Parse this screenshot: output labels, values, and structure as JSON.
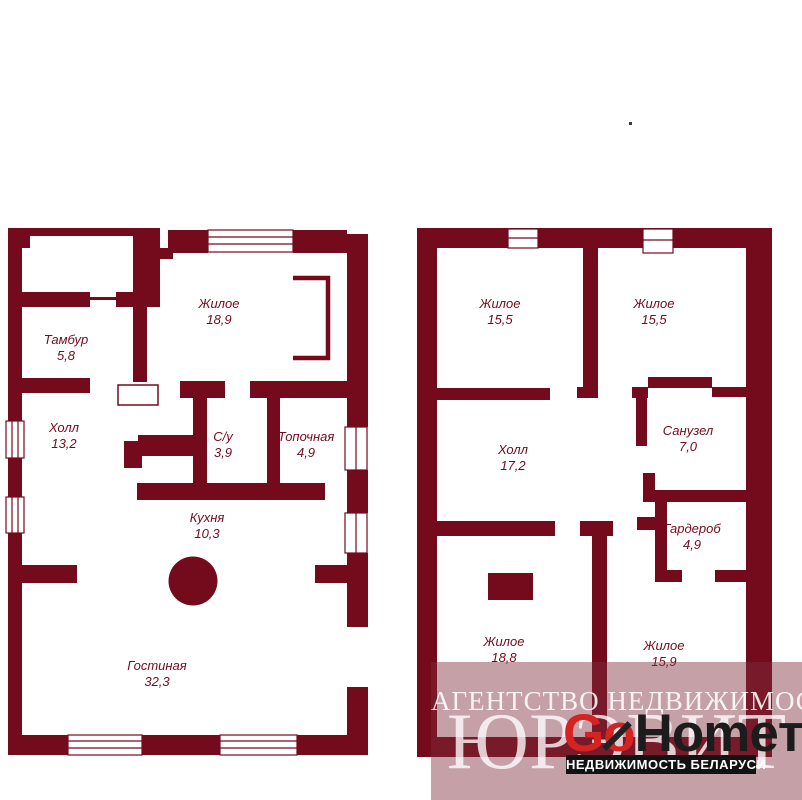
{
  "floor1": {
    "rooms": [
      {
        "name": "Тамбур",
        "area": "5,8"
      },
      {
        "name": "Жилое",
        "area": "18,9"
      },
      {
        "name": "Холл",
        "area": "13,2"
      },
      {
        "name": "С/у",
        "area": "3,9"
      },
      {
        "name": "Топочная",
        "area": "4,9"
      },
      {
        "name": "Кухня",
        "area": "10,3"
      },
      {
        "name": "Гостиная",
        "area": "32,3"
      }
    ]
  },
  "floor2": {
    "rooms": [
      {
        "name": "Жилое",
        "area": "15,5"
      },
      {
        "name": "Жилое",
        "area": "15,5"
      },
      {
        "name": "Холл",
        "area": "17,2"
      },
      {
        "name": "Санузел",
        "area": "7,0"
      },
      {
        "name": "Гардероб",
        "area": "4,9"
      },
      {
        "name": "Жилое",
        "area": "18,8"
      },
      {
        "name": "Жилое",
        "area": "15,9"
      }
    ]
  },
  "watermark": {
    "agency_line": "АГЕНТСТВО НЕДВИЖИМОСТИ",
    "agency_name": "ЮРЭВИТ",
    "logo": {
      "go": "Go",
      "home": "Home",
      "suffix": "т",
      "tagline": "НЕДВИЖИМОСТЬ БЕЛАРУСИ"
    },
    "colors": {
      "overlay": "rgba(126,44,60,0.45)",
      "logo_go": "#d42320",
      "logo_home": "#1c1c1c",
      "banner_bg": "#121212"
    }
  },
  "colors": {
    "wall": "#730b1d",
    "background": "#ffffff",
    "label_text": "#730b1d"
  }
}
